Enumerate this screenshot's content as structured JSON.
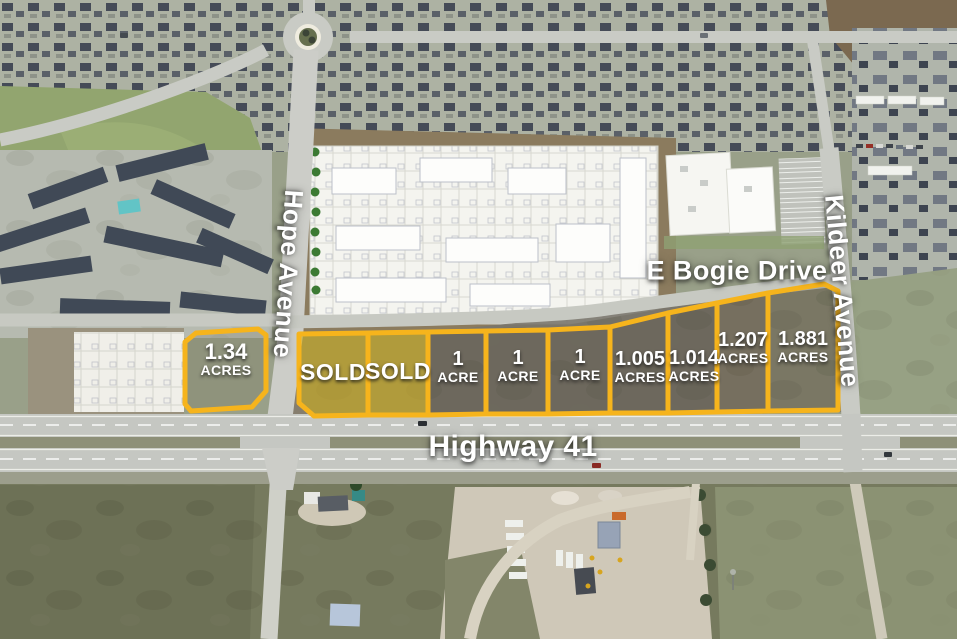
{
  "roads": [
    {
      "name": "Hope Avenue",
      "orientation": "vertical"
    },
    {
      "name": "E Bogie Drive",
      "orientation": "horizontal"
    },
    {
      "name": "Kildeer Avenue",
      "orientation": "vertical"
    },
    {
      "name": "Highway 41",
      "orientation": "horizontal"
    }
  ],
  "parcels": [
    {
      "line1": "1.34",
      "line2": "ACRES",
      "status": "available"
    },
    {
      "line1": "SOLD",
      "status": "sold"
    },
    {
      "line1": "SOLD",
      "status": "sold"
    },
    {
      "line1": "1",
      "line2": "ACRE",
      "status": "available"
    },
    {
      "line1": "1",
      "line2": "ACRE",
      "status": "available"
    },
    {
      "line1": "1",
      "line2": "ACRE",
      "status": "available"
    },
    {
      "line1": "1.005",
      "line2": "ACRES",
      "status": "available"
    },
    {
      "line1": "1.014",
      "line2": "ACRES",
      "status": "available"
    },
    {
      "line1": "1.207",
      "line2": "ACRES",
      "status": "available"
    },
    {
      "line1": "1.881",
      "line2": "ACRES",
      "status": "available"
    }
  ],
  "colors": {
    "parcel_outline": "#F6B41C",
    "sold_fill": "#D4B214",
    "label_text": "#FFFFFF"
  }
}
